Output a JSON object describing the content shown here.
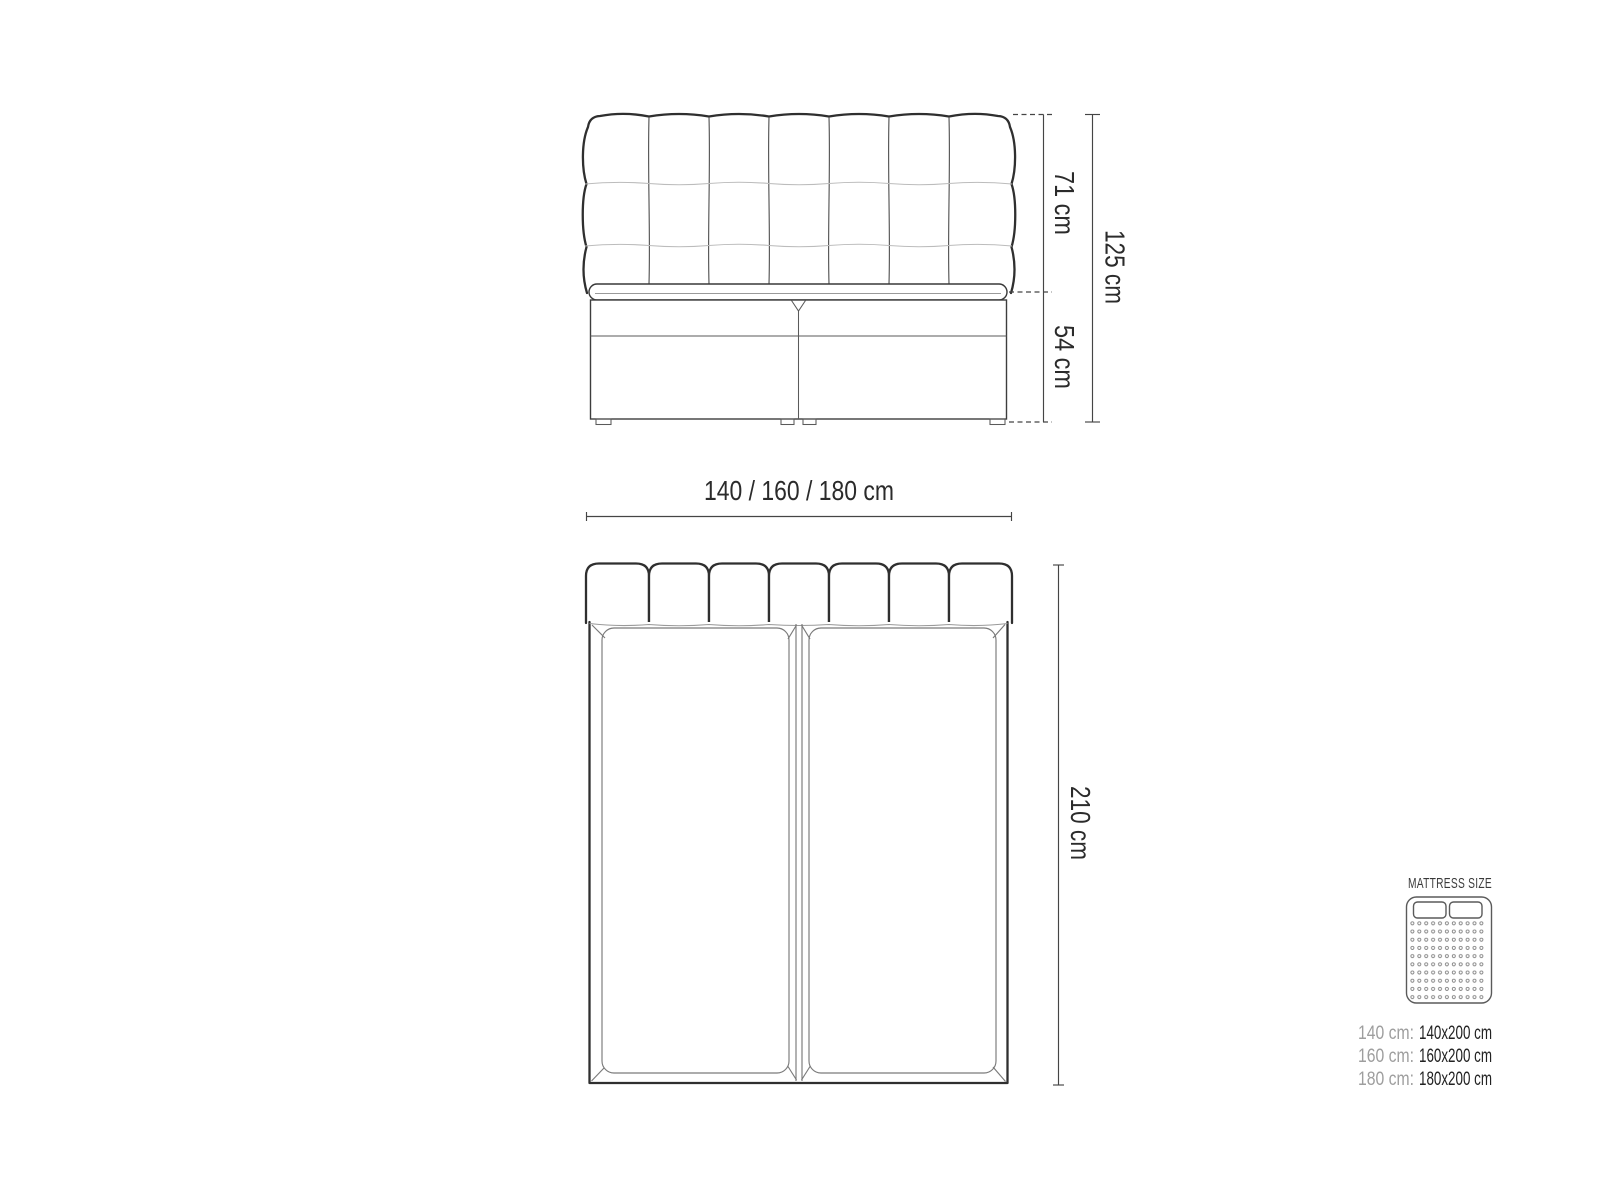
{
  "front_view": {
    "upper_height": "71 cm",
    "lower_height": "54 cm",
    "total_height": "125 cm",
    "width_options": "140 / 160 / 180 cm"
  },
  "top_view": {
    "length": "210 cm"
  },
  "mattress_legend": {
    "title": "MATTRESS SIZE",
    "sizes": [
      {
        "label": "140 cm:",
        "value": "140x200 cm"
      },
      {
        "label": "160 cm:",
        "value": "160x200 cm"
      },
      {
        "label": "180 cm:",
        "value": "180x200 cm"
      }
    ]
  },
  "colors": {
    "outline_dark": "#2f2f2f",
    "line_medium": "#5a5a5a",
    "line_light": "#bcbcbc",
    "dimension_line": "#454545",
    "text_dark": "#2b2b2b",
    "text_gray": "#9e9e9e",
    "background": "#ffffff"
  }
}
